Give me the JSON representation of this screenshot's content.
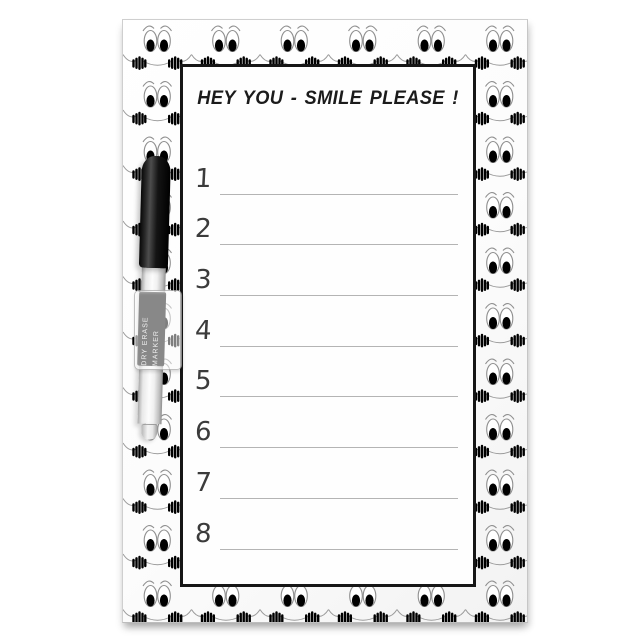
{
  "board": {
    "title": "HEY YOU - SMILE PLEASE !",
    "list": [
      "1",
      "2",
      "3",
      "4",
      "5",
      "6",
      "7",
      "8"
    ]
  },
  "pen": {
    "label_line1": "DRY ERASE",
    "label_line2": "MARKER"
  },
  "icons": {
    "border_pattern": "smiley-face-icon"
  },
  "colors": {
    "board_bg": "#ffffff",
    "panel_border": "#161616",
    "writing_line": "#b4b4b4",
    "title_text": "#1b1b1b",
    "number_text": "#3b3b3b",
    "pen_cap": "#101010",
    "pen_label_bg": "#151515",
    "face_pupil": "#000000",
    "face_outline": "#8f8f8f"
  },
  "pattern_grid": {
    "cols": 6,
    "rows": 11,
    "cell_w": 68.5,
    "cell_h": 55.5
  }
}
